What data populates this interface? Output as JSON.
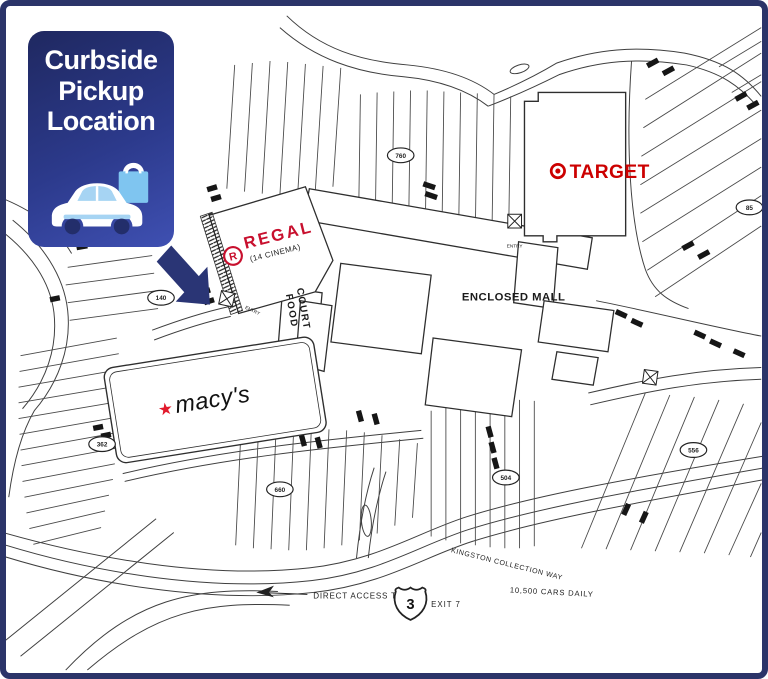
{
  "callout": {
    "line1": "Curbside",
    "line2": "Pickup",
    "line3": "Location"
  },
  "stores": {
    "target": {
      "name": "TARGET",
      "color": "#cc0000"
    },
    "regal": {
      "name": "REGAL",
      "logo_letter": "R",
      "subtitle": "(14 CINEMA)",
      "color": "#c8102e"
    },
    "macys": {
      "name": "macy's",
      "star": "★",
      "star_color": "#e21a2c"
    }
  },
  "mall": {
    "enclosed_mall": "ENCLOSED MALL",
    "food": "FOOD",
    "court": "COURT",
    "entry": "ENTRY"
  },
  "parking": {
    "lot_760": "760",
    "lot_140": "140",
    "lot_362": "362",
    "lot_660": "660",
    "lot_504": "504",
    "lot_556": "556",
    "lot_85": "85"
  },
  "roads": {
    "name": "KINGSTON COLLECTION WAY",
    "traffic": "10,500 CARS DAILY",
    "access": "DIRECT ACCESS TO",
    "route": "3",
    "exit": "EXIT 7"
  }
}
